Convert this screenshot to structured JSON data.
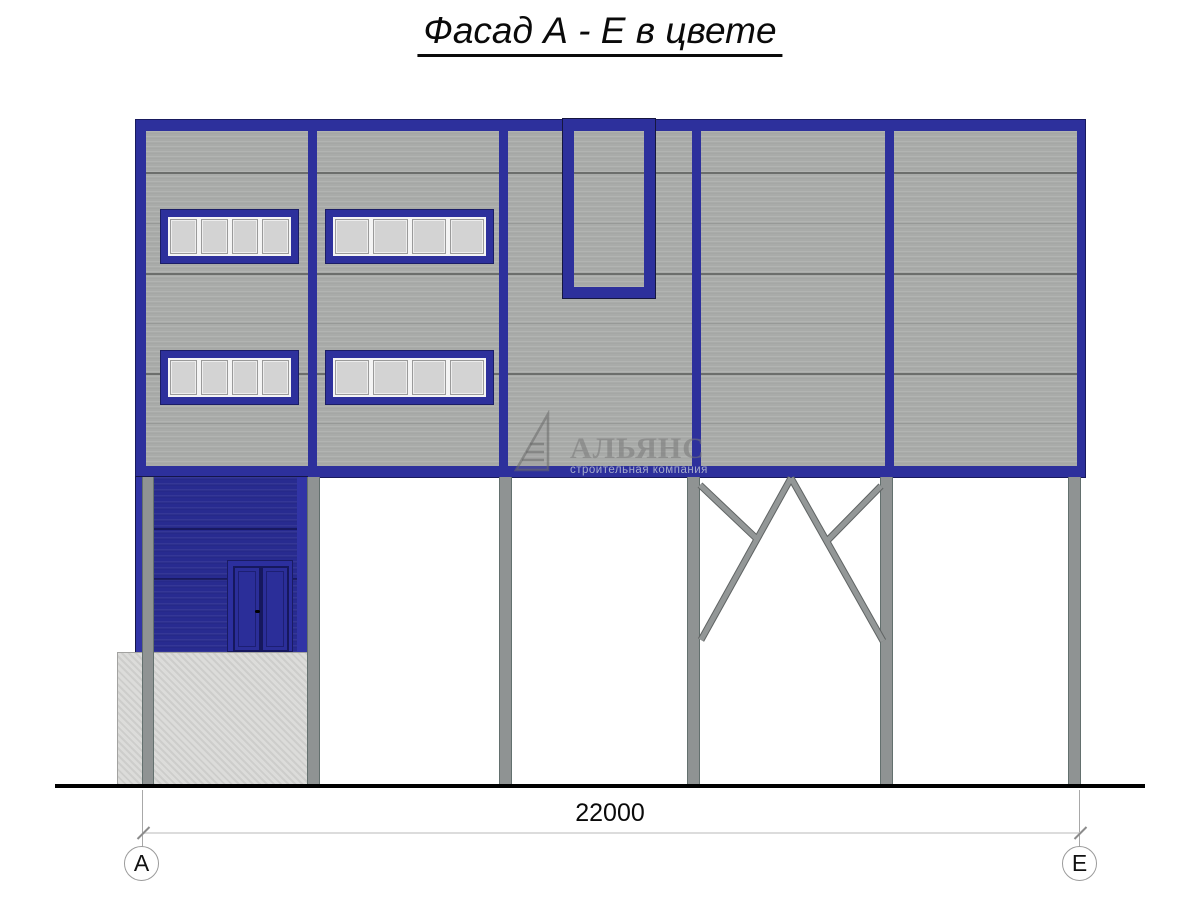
{
  "drawing": {
    "title": "Фасад А - Е в цвете"
  },
  "dimension": {
    "value": "22000"
  },
  "axes": [
    {
      "label": "А"
    },
    {
      "label": "Е"
    }
  ],
  "watermark": {
    "name": "АЛЬЯНС",
    "tagline": "строительная компания",
    "logo_icon": "sail-triangle-icon"
  },
  "colors": {
    "frame_blue": "#2d309c",
    "wall_blue": "#282b90",
    "facade_gray": "#a9aba9",
    "pane_gray": "#d3d3d3",
    "column_gray": "#8f9393",
    "concrete_gray": "#d7d7d5",
    "ground_black": "#000000"
  }
}
